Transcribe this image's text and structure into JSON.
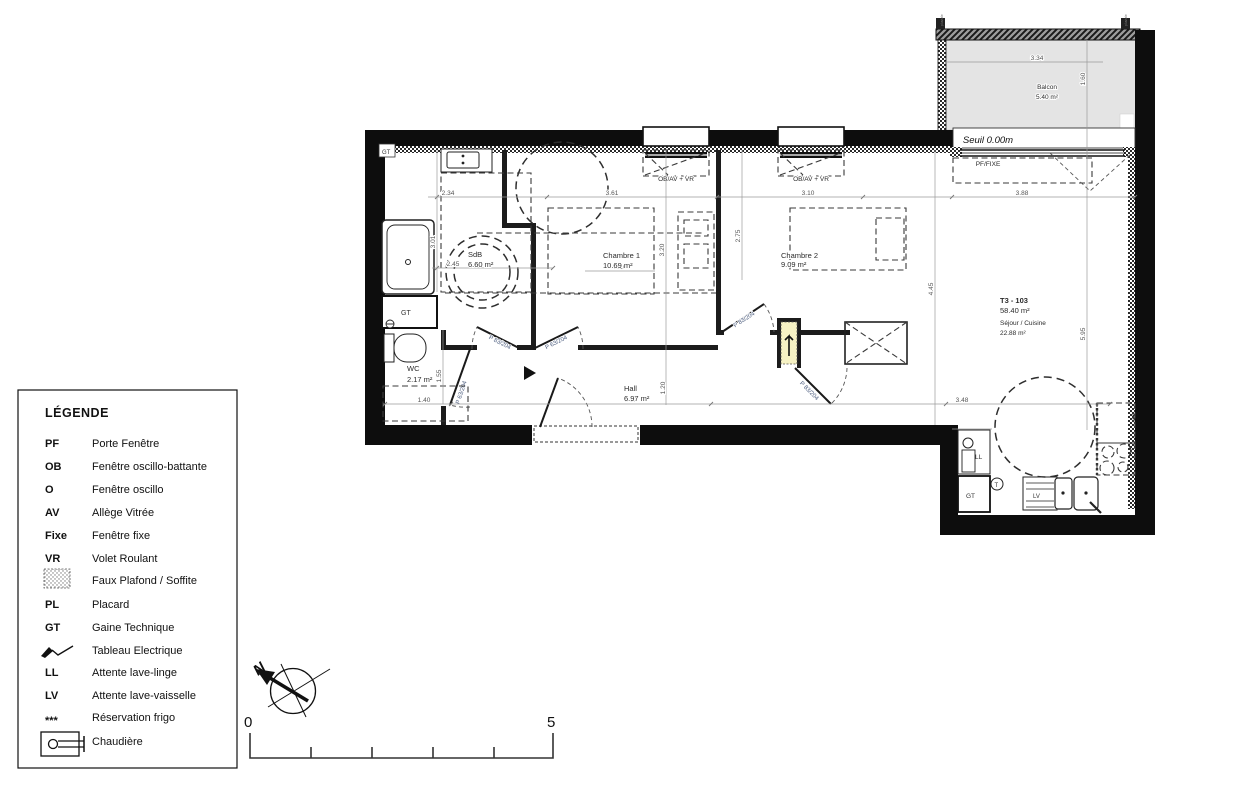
{
  "legend": {
    "title": "LÉGENDE",
    "items": [
      {
        "key": "PF",
        "label": "Porte Fenêtre"
      },
      {
        "key": "OB",
        "label": "Fenêtre oscillo-battante"
      },
      {
        "key": "O",
        "label": "Fenêtre oscillo"
      },
      {
        "key": "AV",
        "label": "Allège Vitrée"
      },
      {
        "key": "Fixe",
        "label": "Fenêtre fixe"
      },
      {
        "key": "VR",
        "label": "Volet Roulant"
      },
      {
        "key": "",
        "label": "Faux Plafond / Soffite"
      },
      {
        "key": "PL",
        "label": "Placard"
      },
      {
        "key": "GT",
        "label": "Gaine Technique"
      },
      {
        "key": "",
        "label": "Tableau Electrique"
      },
      {
        "key": "LL",
        "label": "Attente lave-linge"
      },
      {
        "key": "LV",
        "label": "Attente lave-vaisselle"
      },
      {
        "key": "***",
        "label": "Réservation frigo"
      },
      {
        "key": "",
        "label": "Chaudière"
      }
    ]
  },
  "plan": {
    "unit": {
      "code": "T3 - 103",
      "area": "58.40 m²",
      "main_room": "Séjour / Cuisine",
      "main_room_area": "22.88 m²"
    },
    "rooms": {
      "balcon": {
        "name": "Balcon",
        "area": "5.40 m²"
      },
      "sdb": {
        "name": "SdB",
        "area": "6.60 m²"
      },
      "ch1": {
        "name": "Chambre 1",
        "area": "10.69 m²"
      },
      "ch2": {
        "name": "Chambre 2",
        "area": "9.09 m²"
      },
      "wc": {
        "name": "WC",
        "area": "2.17 m²"
      },
      "hall": {
        "name": "Hall",
        "area": "6.97 m²"
      }
    },
    "openings": {
      "window1": "OB/AV + VR",
      "window2": "OB/AV + VR",
      "seuil": "Seuil 0.00m",
      "bay": "PF/FIXE"
    },
    "doors": {
      "d1": "P 83/204",
      "d2": "P 63/204",
      "d3": "P 63/204",
      "d4": "P 83/204",
      "d5": "P 83/204"
    },
    "marks": {
      "gt": "GT",
      "ll": "LL",
      "lv": "LV",
      "t": "T",
      "frigo": "***",
      "downpipe": "pluviale"
    },
    "dims": {
      "a": "2.34",
      "b": "3.61",
      "c": "3.10",
      "d": "3.88",
      "e": "3.34",
      "f": "1.60",
      "g": "3.01",
      "h": "2.45",
      "i": "3.20",
      "j": "3.10",
      "k": "2.75",
      "l": "4.45",
      "m": "5.95",
      "n": "1.55",
      "o": "1.40",
      "p": "5.50",
      "q": "1.20",
      "r": "3.48"
    }
  },
  "north": {
    "label": "N"
  },
  "scale": {
    "start": "0",
    "end": "5"
  }
}
